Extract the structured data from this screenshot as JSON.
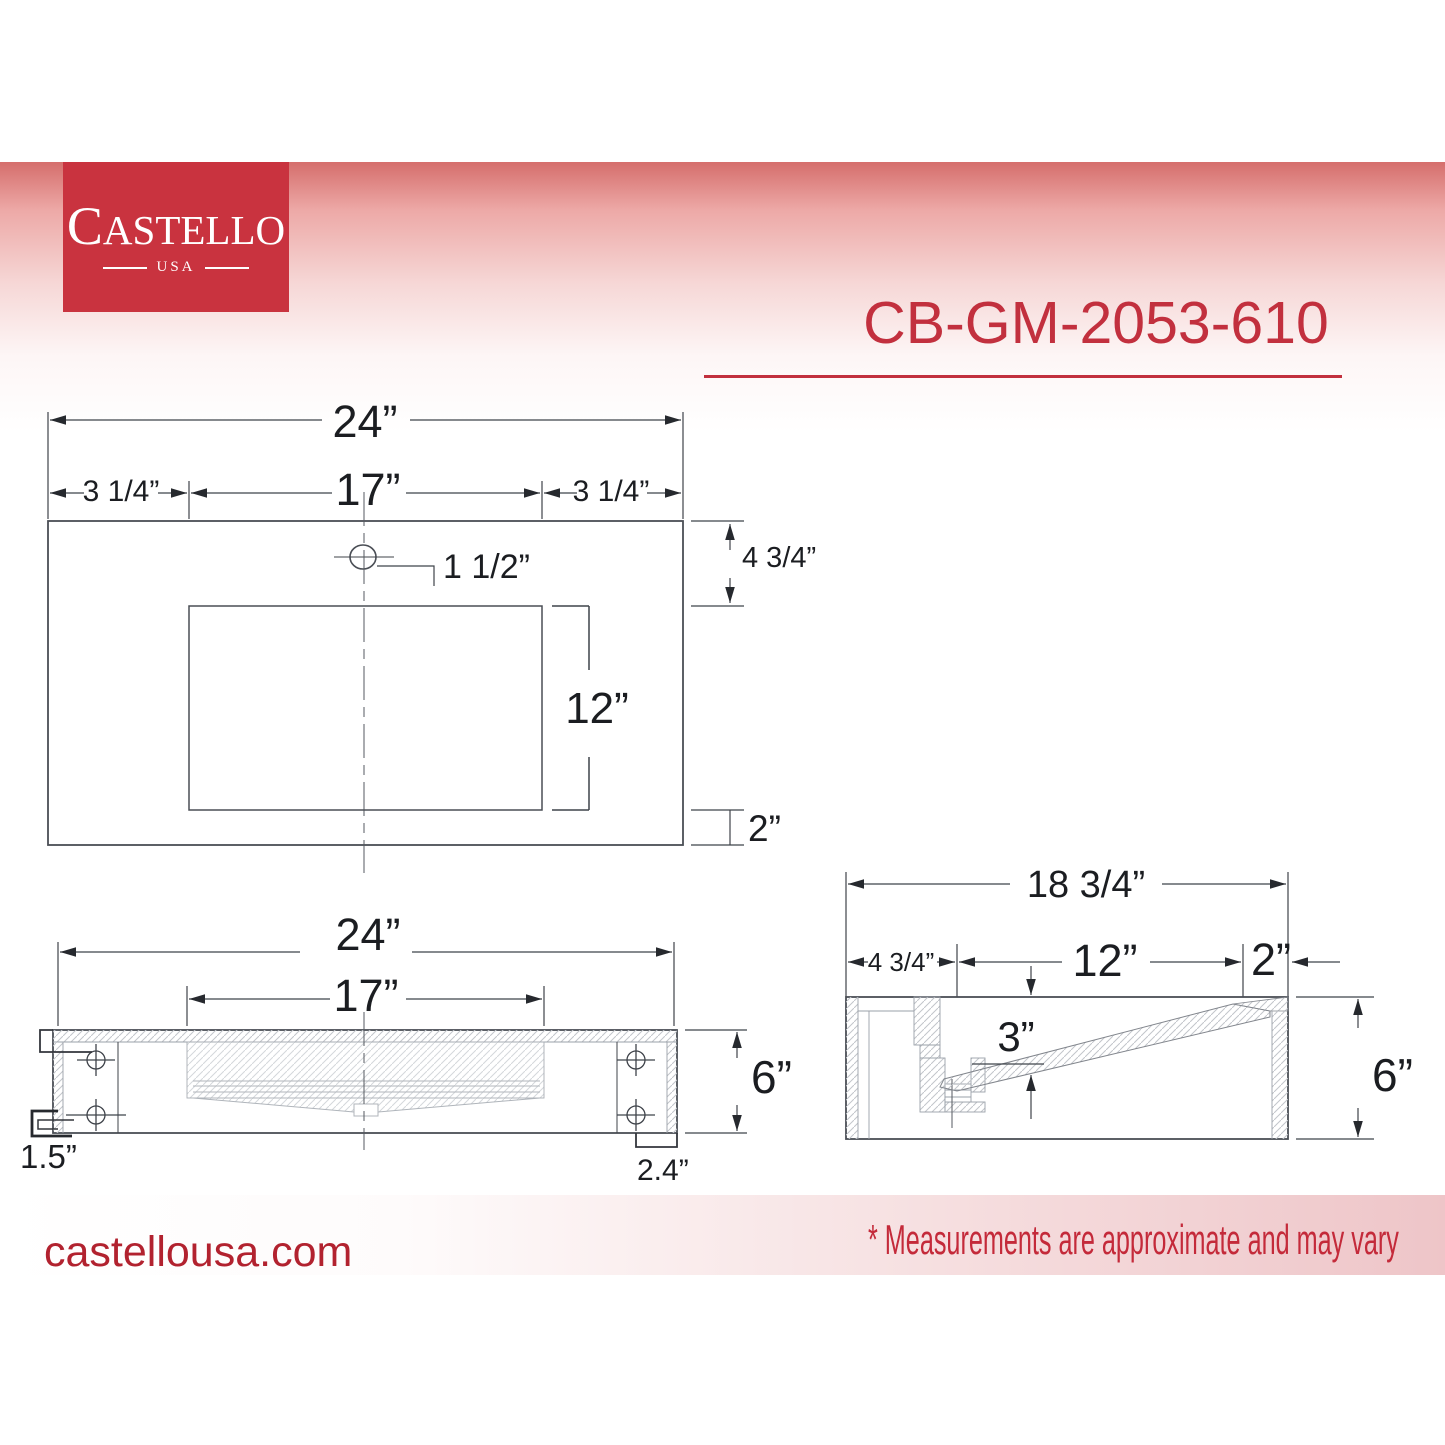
{
  "header": {
    "logo": {
      "brand": "CASTELLO",
      "country": "USA"
    },
    "product_code": "CB-GM-2053-610"
  },
  "footer": {
    "website": "castellousa.com",
    "disclaimer": "* Measurements are approximate and may vary"
  },
  "colors": {
    "brand_red": "#c9333f",
    "accent_red": "#c2303e",
    "gradient_red_top": "#d56e6c",
    "footer_pink": "#eec5c8",
    "line_dark": "#3f434a",
    "hatch_gray": "#c2c5ca"
  },
  "top_view": {
    "overall_width": "24”",
    "left_offset": "3 1/4”",
    "basin_width": "17”",
    "right_offset": "3 1/4”",
    "faucet_hole": "1 1/2”",
    "front_setback": "4 3/4”",
    "basin_front_to_back": "12”",
    "back_margin": "2”"
  },
  "front_view": {
    "overall_width": "24”",
    "basin_width": "17”",
    "overall_height": "6”",
    "bracket_lip": "1.5”",
    "side_flange": "2.4”"
  },
  "side_view": {
    "overall_depth": "18 3/4”",
    "front_ledge": "4 3/4”",
    "basin_length": "12”",
    "back_ledge": "2”",
    "basin_depth": "3”",
    "overall_height": "6”"
  }
}
